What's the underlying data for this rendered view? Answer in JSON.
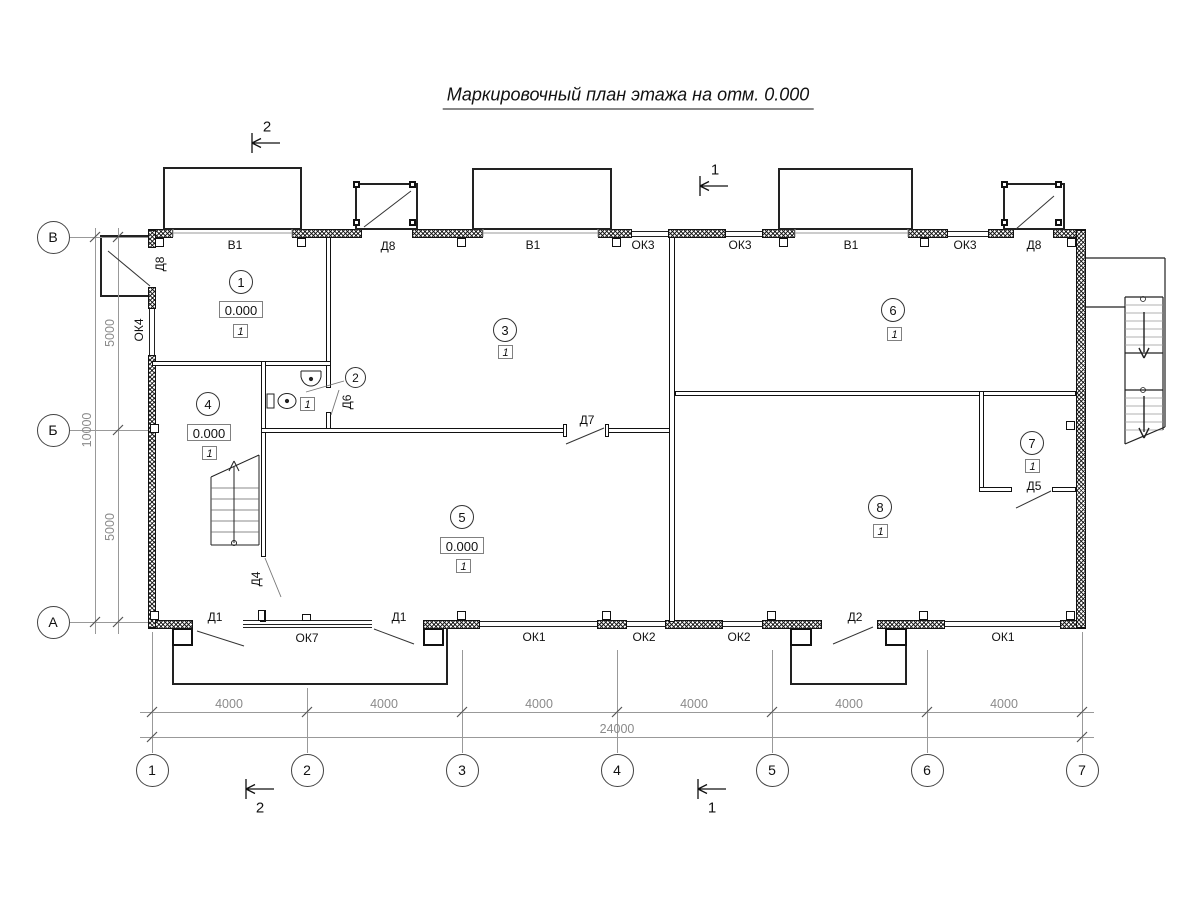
{
  "title": "Маркировочный план этажа на отм. 0.000",
  "rooms": [
    {
      "num": "1",
      "elev": "0.000",
      "type": "1"
    },
    {
      "num": "2",
      "type": "1"
    },
    {
      "num": "3",
      "type": "1"
    },
    {
      "num": "4",
      "elev": "0.000",
      "type": "1"
    },
    {
      "num": "5",
      "elev": "0.000",
      "type": "1"
    },
    {
      "num": "6",
      "type": "1"
    },
    {
      "num": "7",
      "type": "1"
    },
    {
      "num": "8",
      "type": "1"
    }
  ],
  "openings": {
    "top": [
      "В1",
      "Д8",
      "В1",
      "ОК3",
      "ОК3",
      "В1",
      "ОК3",
      "Д8"
    ],
    "bottom": [
      "Д1",
      "ОК7",
      "Д1",
      "ОК1",
      "ОК2",
      "ОК2",
      "Д2",
      "ОК1"
    ],
    "left": [
      "Д8",
      "ОК4"
    ],
    "doors": [
      "Д4",
      "Д5",
      "Д6",
      "Д7"
    ]
  },
  "axes": {
    "rows": [
      "В",
      "Б",
      "А"
    ],
    "cols": [
      "1",
      "2",
      "3",
      "4",
      "5",
      "6",
      "7"
    ]
  },
  "dims": {
    "bays": [
      "4000",
      "4000",
      "4000",
      "4000",
      "4000",
      "4000"
    ],
    "total": "24000",
    "left_top": "5000",
    "left_bottom": "5000",
    "left_total": "10000"
  },
  "sections": {
    "s1": "1",
    "s2": "2"
  }
}
